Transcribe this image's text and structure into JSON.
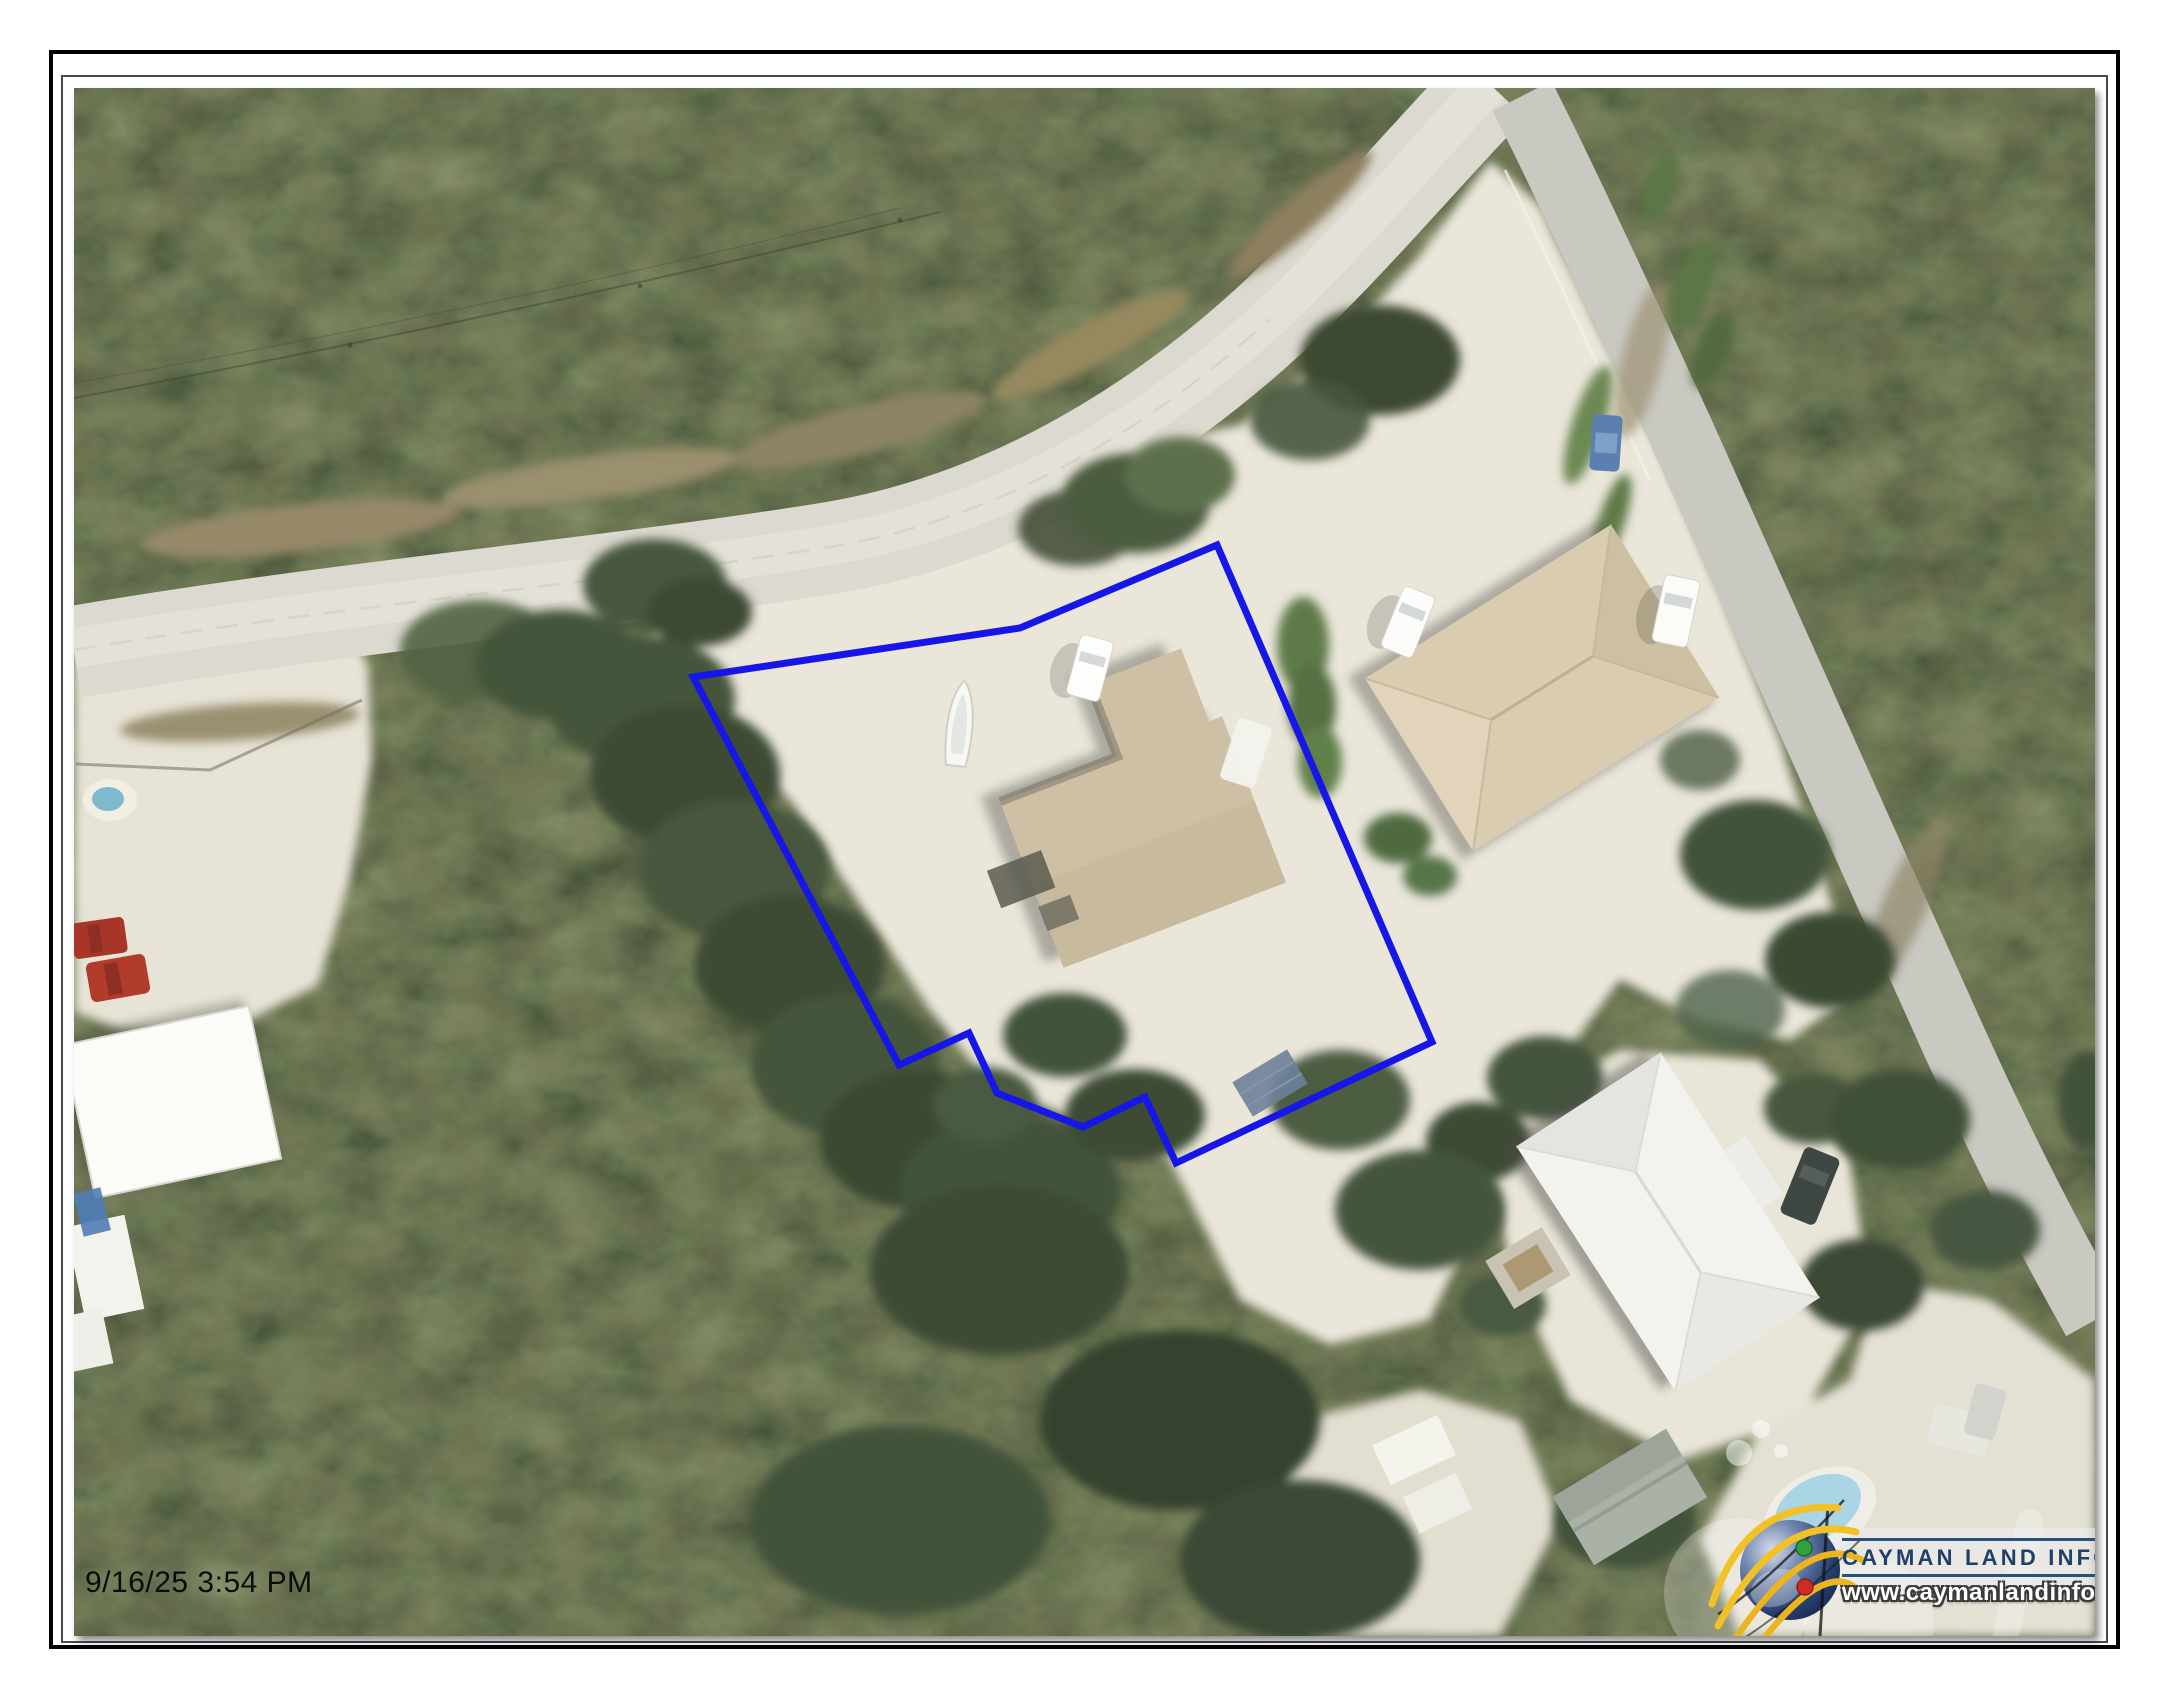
{
  "timestamp": "9/16/25 3:54 PM",
  "logo": {
    "icon": "globe-logo",
    "title": "CAYMAN LAND INFO",
    "url": "www.caymanlandinfo.ky",
    "title_color": "#1f4068",
    "rule_color": "#2a5080"
  },
  "parcel": {
    "points": "693,677 1020,628 1217,545 1432,1042 1176,1163 1145,1097 1083,1127 997,1093 969,1033 899,1065",
    "stroke_color": "#1616e8",
    "stroke_width": "7"
  },
  "colors": {
    "page_background": "#ffffff",
    "frame_border": "#000000",
    "parcel_outline": "#1616e8",
    "road": "#dcd9d0",
    "sand": "#eae6da",
    "vegetation": "#5c6a47",
    "dirt_shoulder": "#96896a",
    "tan_roof": "#d9ccb1",
    "white_roof": "#f2f2ef",
    "timestamp_text": "#0b0b0b"
  }
}
